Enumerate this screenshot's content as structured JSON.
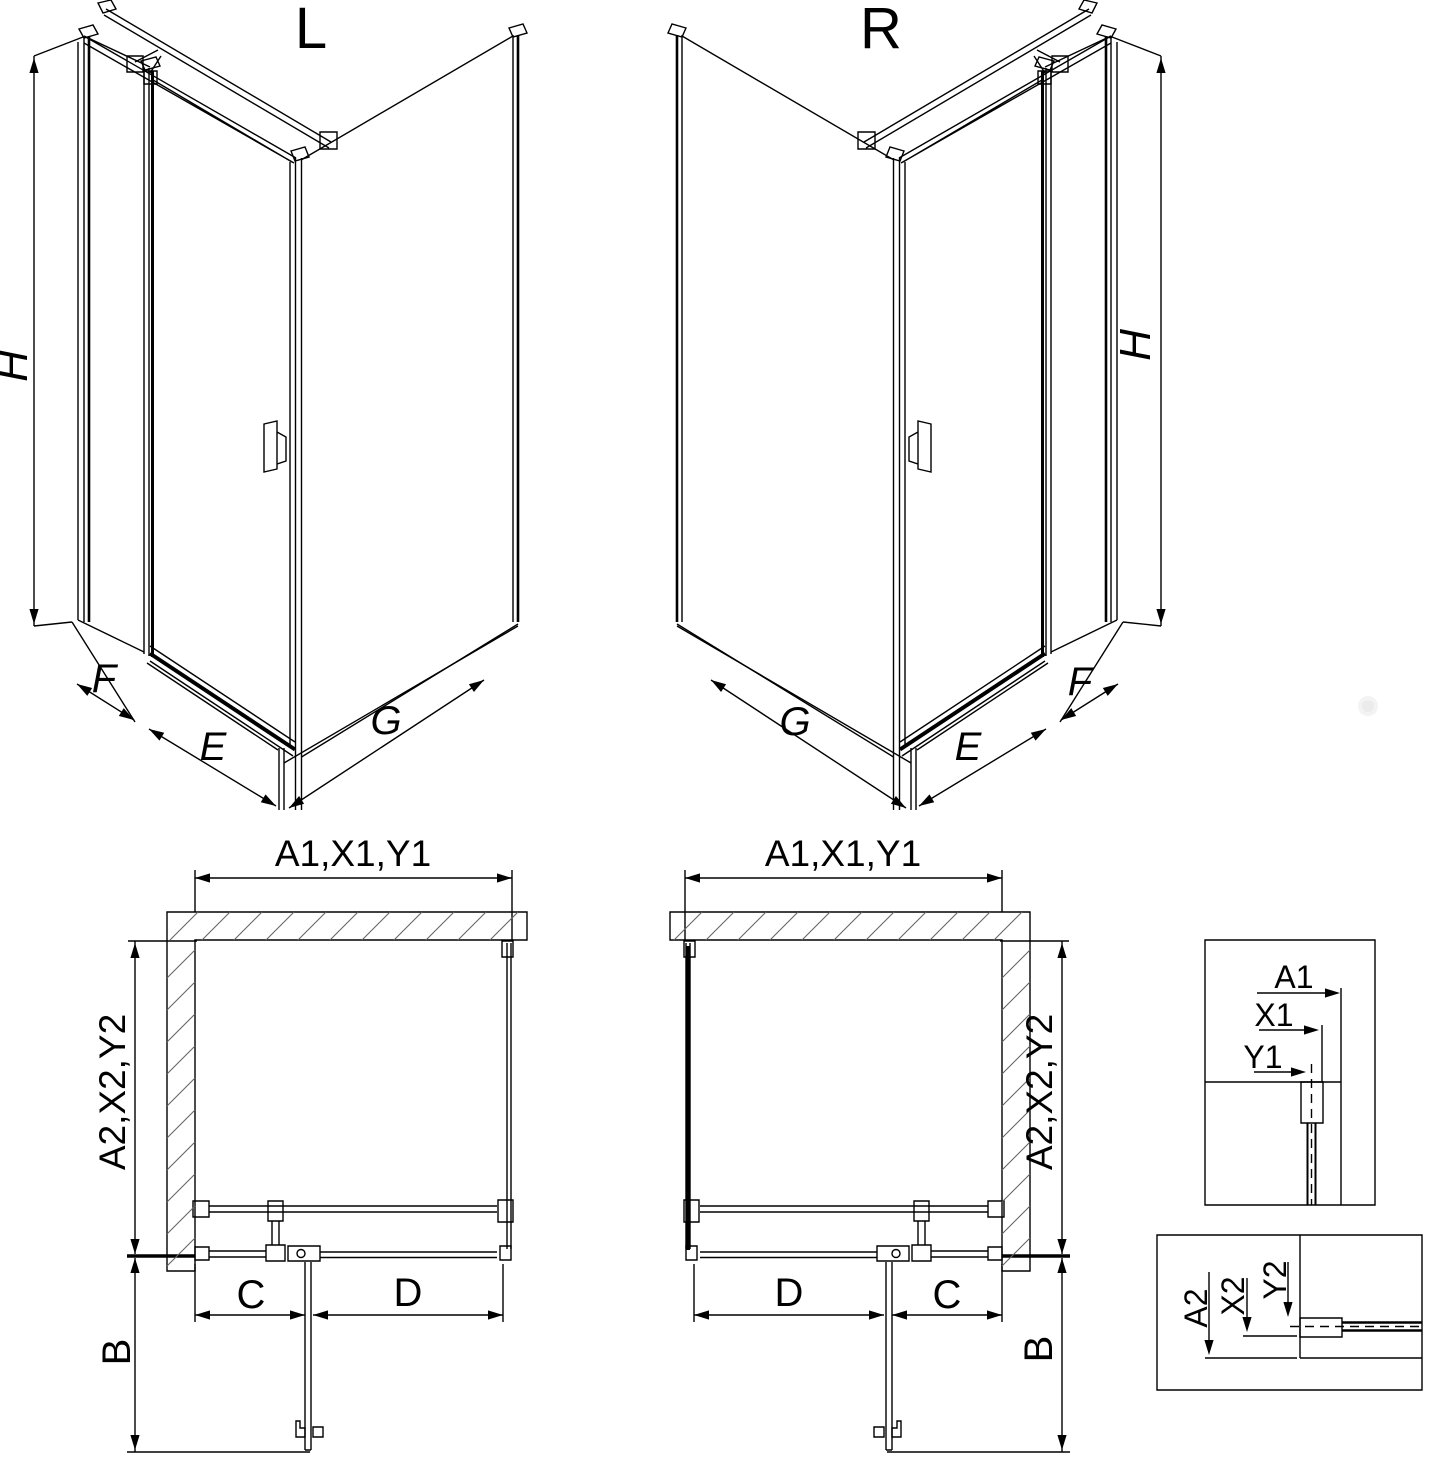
{
  "units": {
    "left": {
      "label": "L",
      "height": "H",
      "widths": {
        "side": "F",
        "door": "E",
        "return": "G"
      }
    },
    "right": {
      "label": "R",
      "height": "H",
      "widths": {
        "side": "F",
        "door": "E",
        "return": "G"
      }
    }
  },
  "plans": {
    "left": {
      "top": "A1,X1,Y1",
      "side": "A2,X2,Y2",
      "c": "C",
      "d": "D",
      "b": "B"
    },
    "right": {
      "top": "A1,X1,Y1",
      "side": "A2,X2,Y2",
      "c": "C",
      "d": "D",
      "b": "B"
    }
  },
  "details": {
    "top": {
      "a1": "A1",
      "x1": "X1",
      "y1": "Y1"
    },
    "bottom": {
      "a2": "A2",
      "x2": "X2",
      "y2": "Y2"
    }
  },
  "colors": {
    "line": "#000000",
    "hatch": "#666666",
    "background": "#ffffff"
  }
}
